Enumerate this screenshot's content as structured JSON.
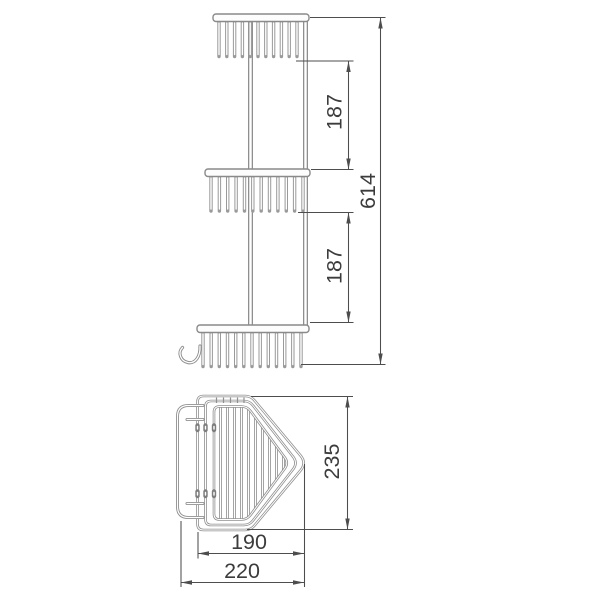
{
  "drawing": {
    "background": "#ffffff",
    "line_color": "#919191",
    "dimension_line_color": "#4d4d4d",
    "text_color": "#3c3c3c",
    "dimensions": {
      "upper_tier_spacing": "187",
      "lower_tier_spacing": "187",
      "overall_height": "614",
      "side_depth": "235",
      "basket_width": "190",
      "overall_width": "220"
    }
  }
}
